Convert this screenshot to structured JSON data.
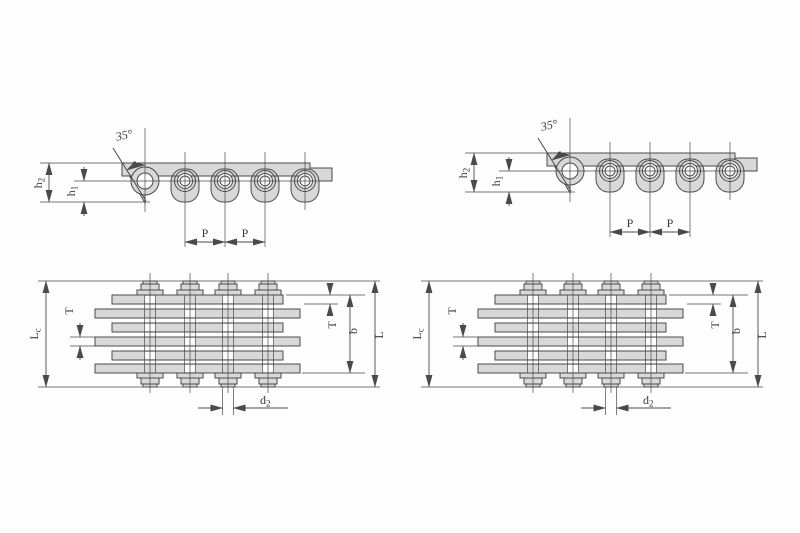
{
  "figure": {
    "background": "#fdfdfd",
    "line_color": "#4a4a4a",
    "fill_color": "#d8d8d8",
    "kind": "leaf-chain engineering dimension drawing, two chain variants, side view and plan (lacing) view"
  },
  "labels": {
    "angle": "35°",
    "h2_base": "h",
    "h2_sub": "2",
    "h1_base": "h",
    "h1_sub": "1",
    "pitch": "P",
    "lc_base": "L",
    "lc_sub": "c",
    "t": "T",
    "b": "b",
    "l": "L",
    "d2_base": "d",
    "d2_sub": "2"
  }
}
